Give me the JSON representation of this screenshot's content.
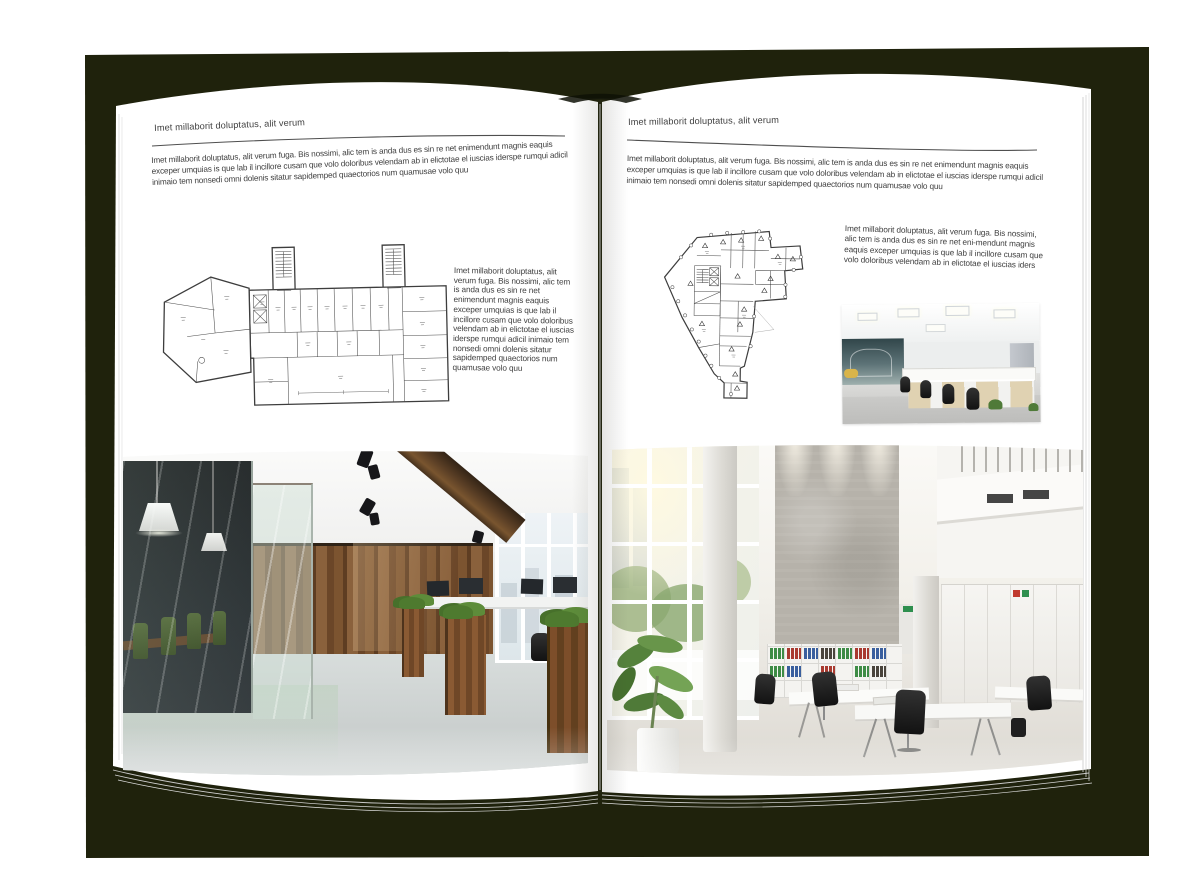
{
  "page_background": "#ffffff",
  "book": {
    "cover_color": "#1f220c",
    "page_color": "#ffffff",
    "text_color": "#3e3e3e",
    "rule_color": "#4f4f4f",
    "page_edge_line_color": "#cfcfcf"
  },
  "left_page": {
    "header": "Imet millaborit doluptatus, alit verum",
    "intro": "Imet millaborit doluptatus, alit verum fuga. Bis nossimi, alic tem is anda dus es sin re net enimendunt magnis eaquis exceper umquias is que lab il incillore cusam que volo doloribus velendam ab in elictotae el iuscias iderspe rumqui adicil inimaio tem nonsedi omni dolenis sitatur sapidemped quaectorios num quamusae volo quu",
    "side_text": "Imet millaborit doluptatus, alit verum fuga. Bis nossimi, alic tem is anda dus es sin re net enimendunt magnis eaquis exceper umquias is que lab il incillore cusam que volo doloribus velendam ab in elictotae el iuscias iderspe rumqui adicil inimaio tem nonsedi omni dolenis sitatur sapidemped quaectorios num quamusae volo quu",
    "floor_plan": "technical floor plan - elongated building with two stair towers",
    "photo": "office interior - glass meeting room with green chairs, wood plank wall, desks by windows"
  },
  "right_page": {
    "header": "Imet millaborit doluptatus, alit verum",
    "intro": "Imet millaborit doluptatus, alit verum fuga. Bis nossimi, alic tem is anda dus es sin re net enimendunt magnis eaquis exceper umquias is que lab il incillore cusam que volo doloribus velendam ab in elictotae el iuscias iderspe rumqui adicil inimaio tem nonsedi omni dolenis sitatur sapidemped quaectorios num quamusae volo quu",
    "side_text": "Imet millaborit doluptatus, alit verum fuga. Bis nossimi, alic tem is anda dus es sin re net eni-mendunt magnis eaquis exceper umquias is que lab il incillore cusam que volo doloribus velendam ab in elictotae el iuscias iders",
    "floor_plan": "technical floor plan - irregular building with column grid",
    "photo_small": "open plan office - desk rows with light wood cabinets and black chairs",
    "photo_large": "double-height office atrium - tall windows, concrete wall, binder shelves, white desks"
  }
}
